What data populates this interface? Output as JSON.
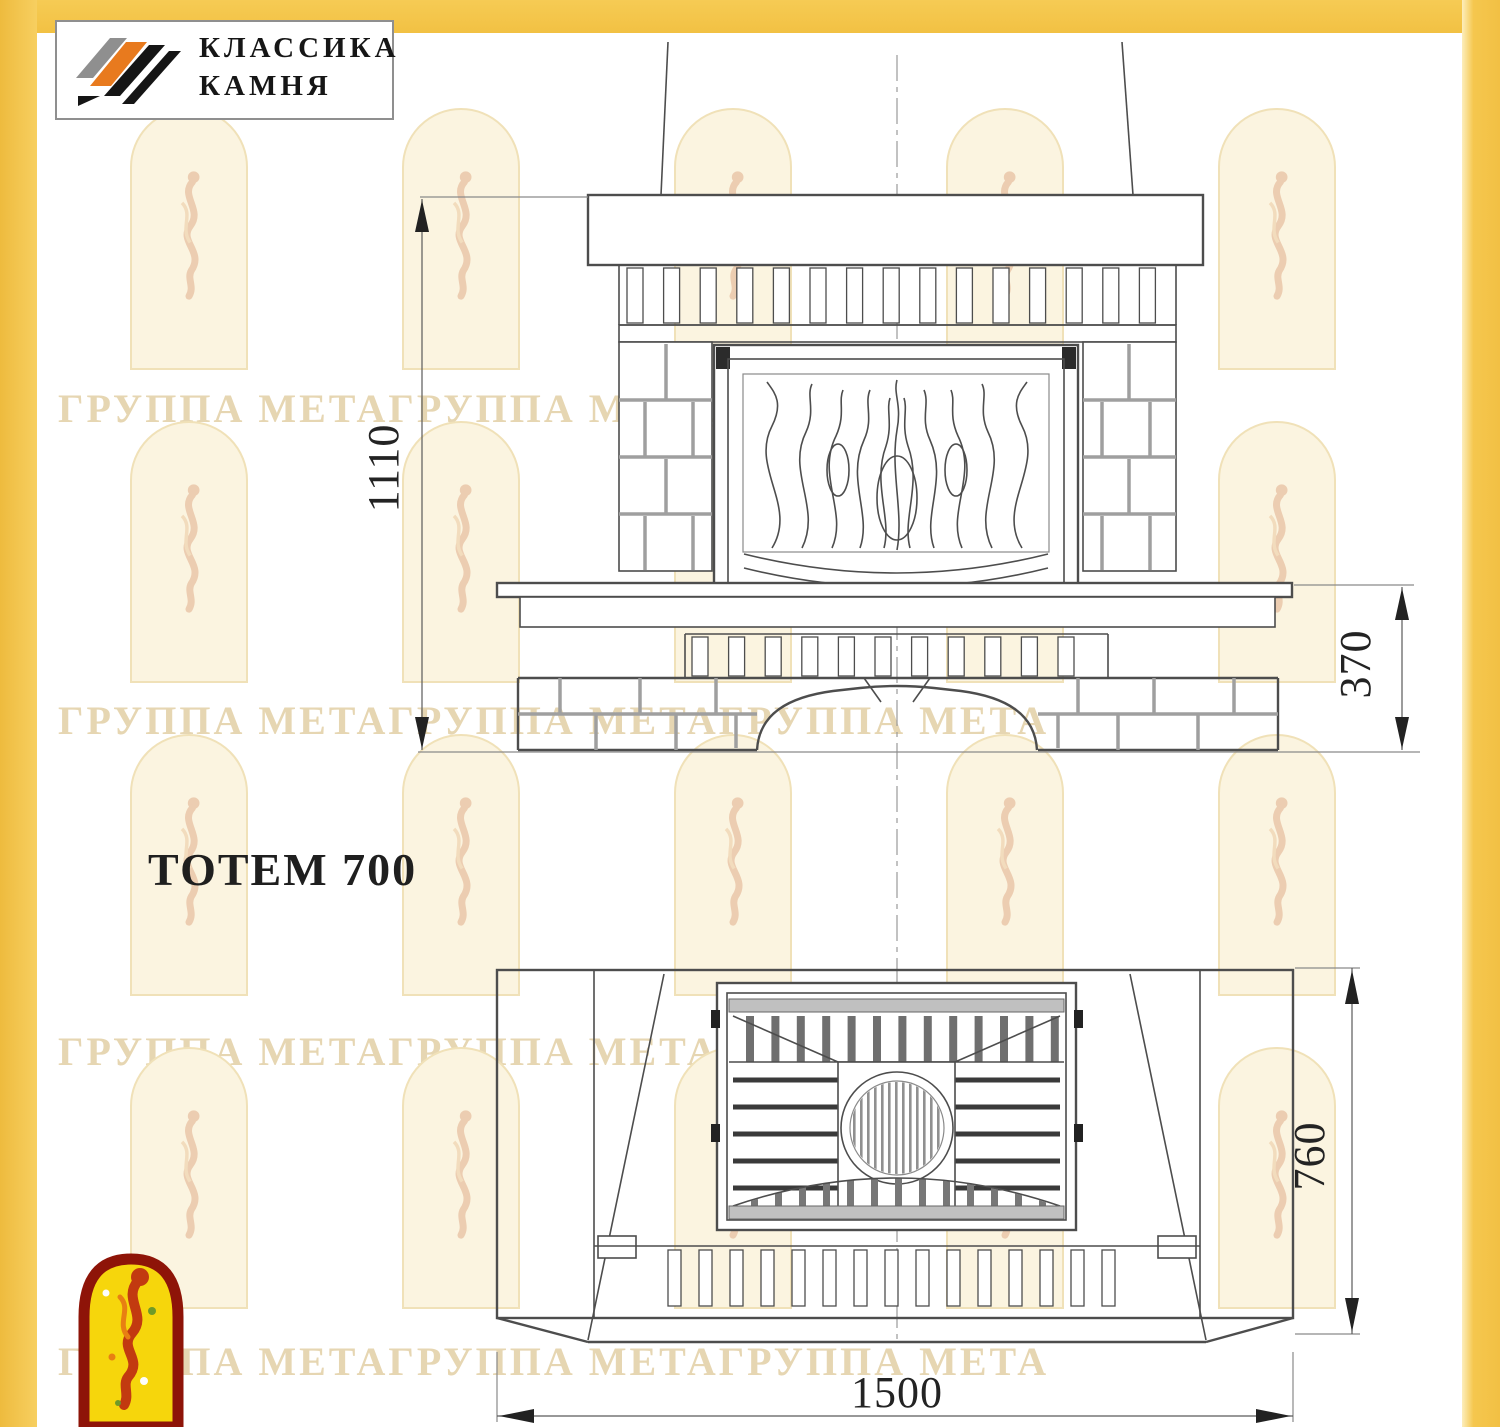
{
  "logo": {
    "line1": "КЛАССИКА",
    "line2": "КАМНЯ"
  },
  "title": {
    "model": "ТОТЕМ 700"
  },
  "watermark": {
    "text": "ГРУППА МЕТАГРУППА МЕТАГРУППА МЕТА"
  },
  "dimensions": {
    "front_height": "1110",
    "plinth_height": "370",
    "plan_depth": "760",
    "plan_width": "1500"
  },
  "colors": {
    "page_border": "#f3c24b",
    "logo_orange": "#e87a1e",
    "emblem_red": "#8e1408",
    "emblem_yellow": "#f6d60c",
    "drawing_line": "#4d4d4d"
  }
}
